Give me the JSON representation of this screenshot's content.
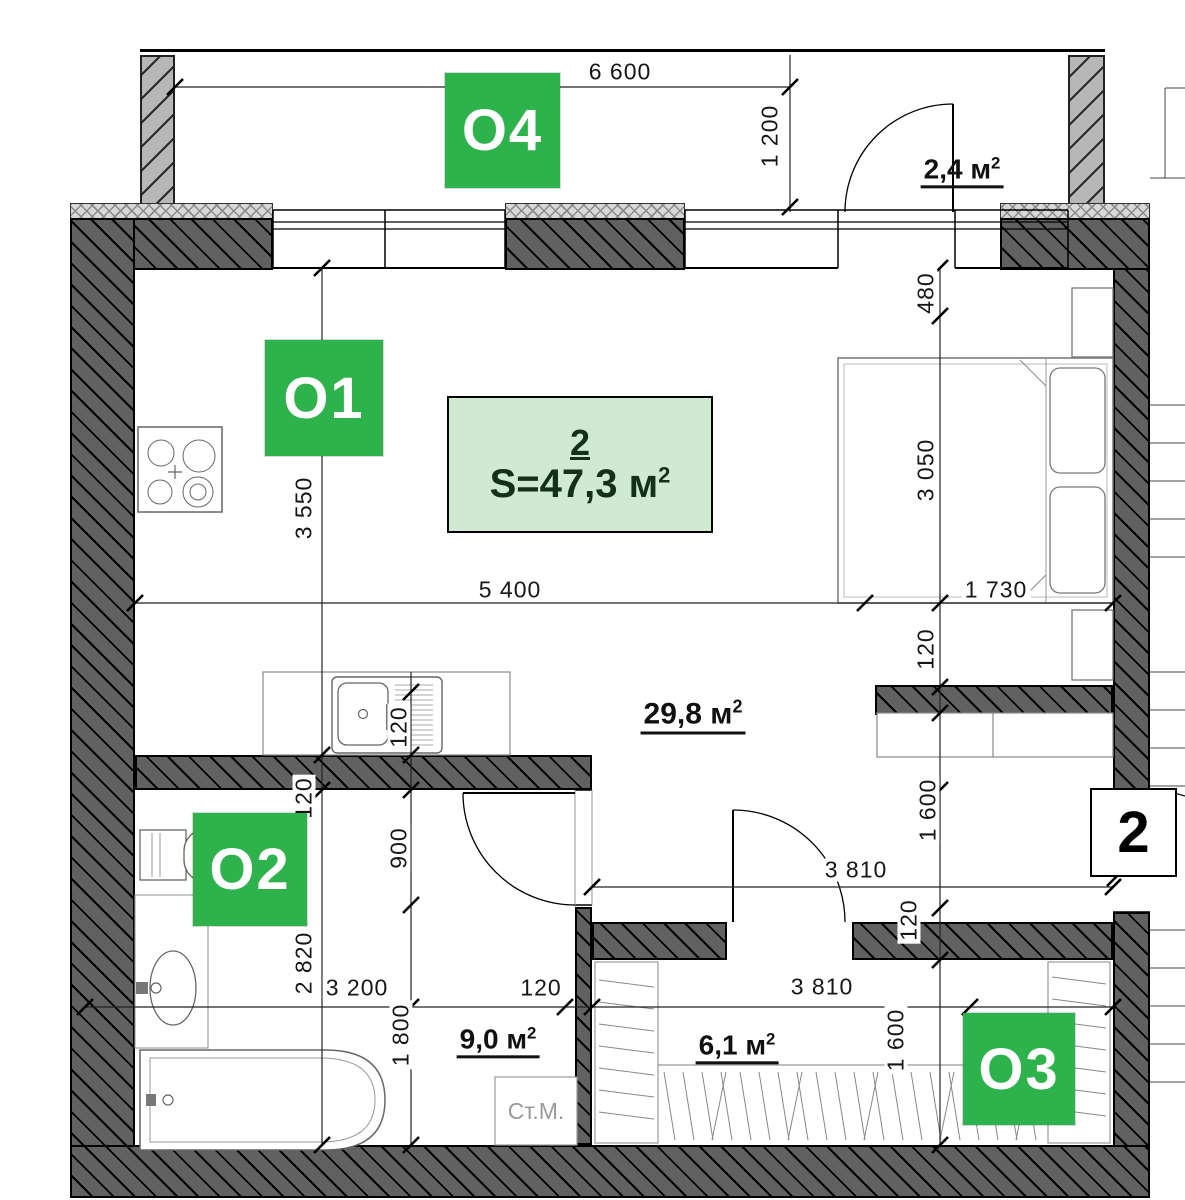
{
  "markers": {
    "o1": "O1",
    "o2": "O2",
    "o3": "O3",
    "o4": "O4"
  },
  "info_box": {
    "number": "2",
    "area": "S=47,3 м",
    "area_sup": "2"
  },
  "entrance_badge": "2",
  "areas": {
    "balcony": {
      "value": "2,4 м",
      "sup": "2"
    },
    "living": {
      "value": "29,8 м",
      "sup": "2"
    },
    "hall": {
      "value": "9,0 м",
      "sup": "2"
    },
    "wardrobe": {
      "value": "6,1 м",
      "sup": "2"
    }
  },
  "labels": {
    "washing_machine": "Ст.М."
  },
  "dimensions": {
    "balcony_width": "6 600",
    "balcony_depth": "1 200",
    "bed_offset": "480",
    "bed_zone_height": "3 050",
    "bed_width": "1 730",
    "kitchen_zone_height": "3 550",
    "living_width": "5 400",
    "wall_at_bed": "120",
    "entry_zone_height": "1 600",
    "wall_at_entry": "120",
    "counter_wall": "120",
    "bath_wall_top": "120",
    "bath_door_height": "900",
    "bath_height": "2 820",
    "bath_width": "3 200",
    "hall_height": "1 800",
    "hall_wall": "120",
    "entry_width": "3 810",
    "wardrobe_width": "3 810",
    "wardrobe_height": "1 600"
  },
  "colors": {
    "marker_green": "#2eb24c",
    "info_fill": "#cfe9d2",
    "wall_dark": "#616161",
    "wall_light": "#b7b7b7"
  }
}
